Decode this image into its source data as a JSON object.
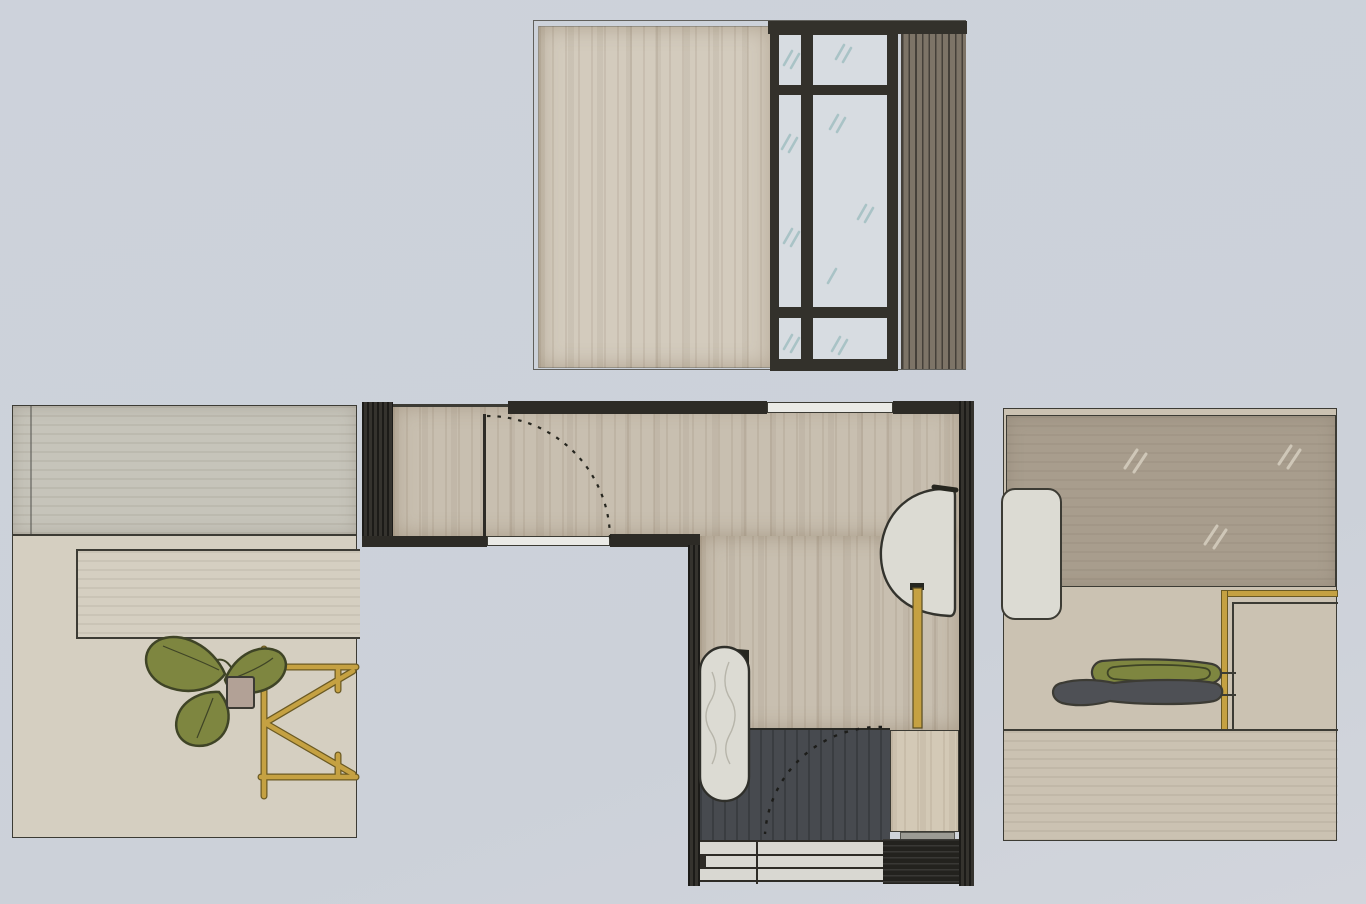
{
  "document_kind": "hand-drawn interior design presentation: central floor plan with three wall elevations (marker rendering, no text on sheet)",
  "palette": {
    "bg": "#cdd2db",
    "bg2": "#ccd1d9",
    "bg3": "#d2d5dc",
    "line": "#3c3b34",
    "wall_dark": "#2d2b26",
    "frame_dark": "#33312b",
    "wall_beige": "#d3cbbd",
    "glass": "#d7dce1",
    "glass_tick": "#a9c3c6",
    "slat": "#7d7467",
    "slat_line": "#454039",
    "cream": "#d5cfc1",
    "cream_gray": "#c6c4ba",
    "cream2": "#cbc2b2",
    "mirror": "#a89d8d",
    "floor_tan": "#c8bfb0",
    "gap_white": "#eaeae6",
    "rug_dark": "#474a4f",
    "white_obj": "#dcdbd3",
    "gold": "#c5a142",
    "gold_edge": "#6b5a23",
    "leaf_green": "#7e8640",
    "leaf_dark": "#3f4426",
    "pot_pink": "#b2a196",
    "platform_beige": "#d3c9b6",
    "steps_light": "#d9d8d2",
    "black_block": "#23221e",
    "gray_strip": "#9c9b94"
  },
  "panels": {
    "top_elevation": {
      "label": "wall elevation: plain wall, six-pane glazed window, vertical wood-slat screen",
      "window": {
        "pane_columns": 2,
        "pane_rows": 3,
        "reflection_marks": "diagonal double ticks"
      }
    },
    "left_elevation": {
      "label": "wall elevation: upper wall band, long recessed niche, potted plant on gold trestle side table",
      "elements": [
        "upper-wall-band",
        "recessed-niche",
        "plant-pot",
        "three-leaf-plant",
        "gold-trestle-table"
      ]
    },
    "right_elevation": {
      "label": "wall elevation: mirror panel, rounded white seat, gold handrail, pair of shoes, floor line",
      "elements": [
        "mirror-panel",
        "rounded-seat",
        "gold-handrail",
        "olive-shoe",
        "gray-shoe",
        "floor-line"
      ]
    },
    "floor_plan": {
      "label": "L-shaped entry hall plan",
      "elements": [
        "thick-dark-walls",
        "window-opening-top",
        "doorway-with-open-door",
        "dashed-door-swing-arc",
        "oval-textured-mat",
        "rounded-basin-against-wall",
        "gold-floor-lamp",
        "sunken-dark-entry-floor",
        "entry-door-swing-arc",
        "side-platform",
        "three-entry-steps",
        "storage-block"
      ]
    }
  }
}
